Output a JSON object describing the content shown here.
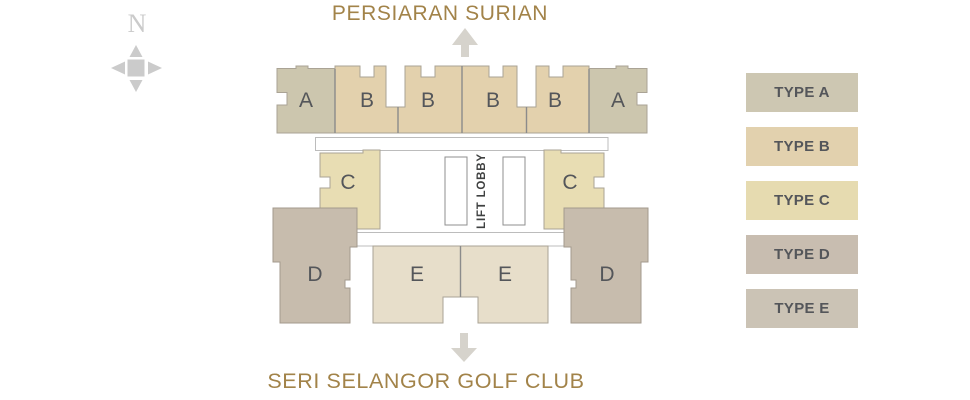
{
  "titles": {
    "top": "PERSIARAN SURIAN",
    "bottom": "SERI SELANGOR GOLF CLUB"
  },
  "compass": {
    "label": "N"
  },
  "plan": {
    "lift_lobby_label": "LIFT LOBBY",
    "units": [
      {
        "label": "A"
      },
      {
        "label": "B"
      },
      {
        "label": "B"
      },
      {
        "label": "B"
      },
      {
        "label": "B"
      },
      {
        "label": "A"
      },
      {
        "label": "C"
      },
      {
        "label": "C"
      },
      {
        "label": "D"
      },
      {
        "label": "D"
      },
      {
        "label": "E"
      },
      {
        "label": "E"
      }
    ]
  },
  "legend": {
    "items": [
      {
        "label": "TYPE A",
        "color": "#cdc7b2"
      },
      {
        "label": "TYPE B",
        "color": "#e2d1ae"
      },
      {
        "label": "TYPE C",
        "color": "#e6dbb0"
      },
      {
        "label": "TYPE D",
        "color": "#c8bdb0"
      },
      {
        "label": "TYPE E",
        "color": "#cbc3b5"
      }
    ]
  },
  "colors": {
    "type_a": "#ccc6ae",
    "type_b": "#e3d1ad",
    "type_c": "#e8ddb3",
    "type_d": "#c7bcad",
    "type_e": "#e7deca",
    "street_text": "#a28349",
    "unit_text": "#54565a",
    "lift_text": "#3f4141",
    "arrow": "#d6d3cc",
    "compass": "#cbcbcb"
  }
}
